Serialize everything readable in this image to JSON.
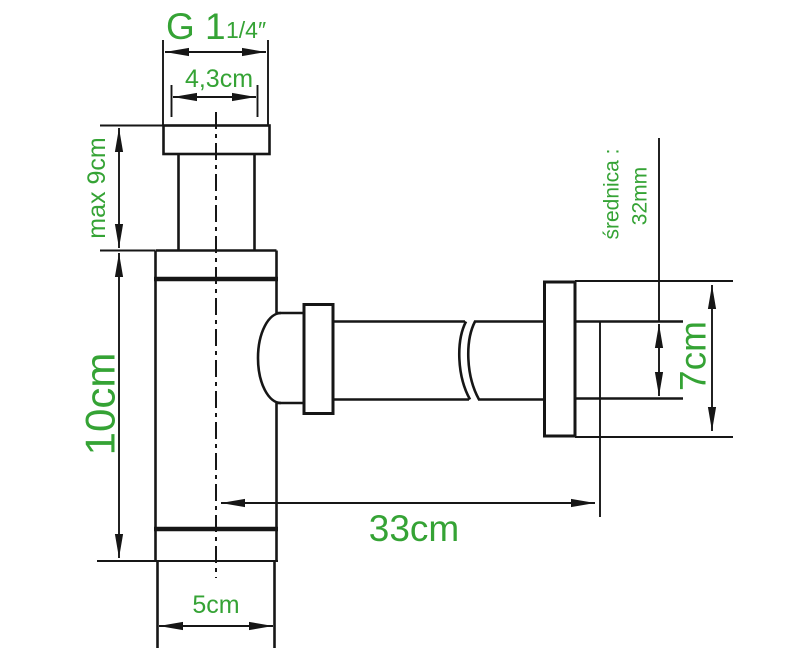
{
  "diagram": {
    "colors": {
      "background": "#ffffff",
      "line": "#161616",
      "accent_green": "#35a335"
    },
    "labels": {
      "thread_size_main": "G 1",
      "thread_size_fraction": "1/4″",
      "top_nut_width": "4,3cm",
      "max_inlet_height": "max 9cm",
      "body_height": "10cm",
      "horizontal_length": "33cm",
      "pipe_diameter_title": "średnica :",
      "pipe_diameter_value": "32mm",
      "wall_flange_height": "7cm",
      "body_width": "5cm"
    }
  }
}
